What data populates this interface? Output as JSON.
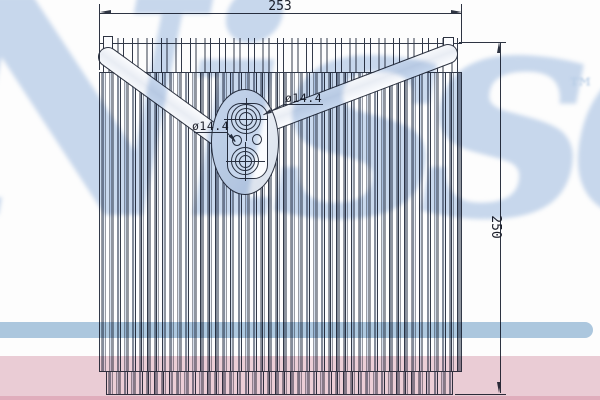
{
  "dimensions": {
    "overall_width": "253",
    "overall_height": "250",
    "port_diameter_left": "ø14.4",
    "port_diameter_right": "ø14.4"
  },
  "watermark": {
    "brand_script": "Nissens",
    "trademark_symbol": "™",
    "script_color": "#c9d9ee",
    "band_blue_color": "#aec9e0",
    "band_pink_color": "#ecced7",
    "band_pink_edge_color": "#e2afbe"
  },
  "style": {
    "ink_color": "#2e3442",
    "fin_tint": "#d8e1ee",
    "background_color": "#fdfdfd"
  }
}
